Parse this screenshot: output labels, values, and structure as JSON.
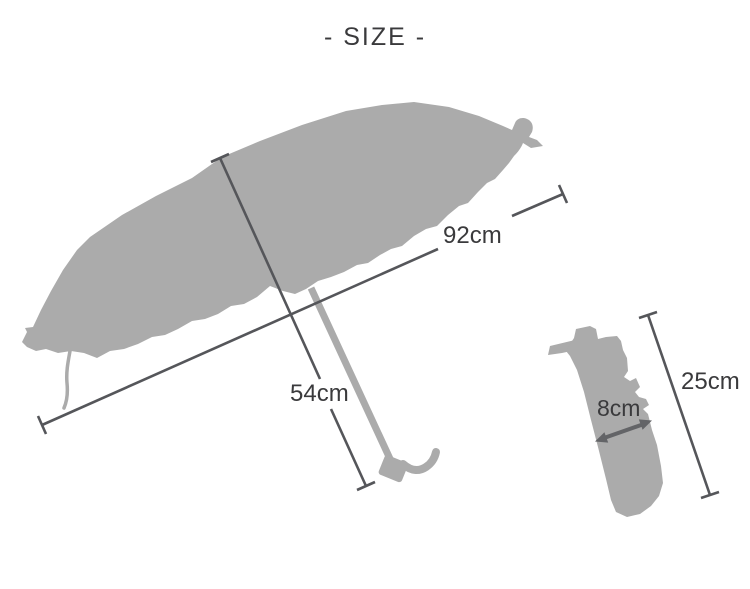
{
  "title": "- SIZE -",
  "colors": {
    "background": "#ffffff",
    "silhouette": "#ababab",
    "line": "#55565a",
    "arrow": "#636467",
    "text": "#3a3a3c"
  },
  "measurements": {
    "open_umbrella": {
      "canopy_width": "92cm",
      "height": "54cm"
    },
    "folded_umbrella": {
      "length": "25cm",
      "width": "8cm"
    }
  }
}
